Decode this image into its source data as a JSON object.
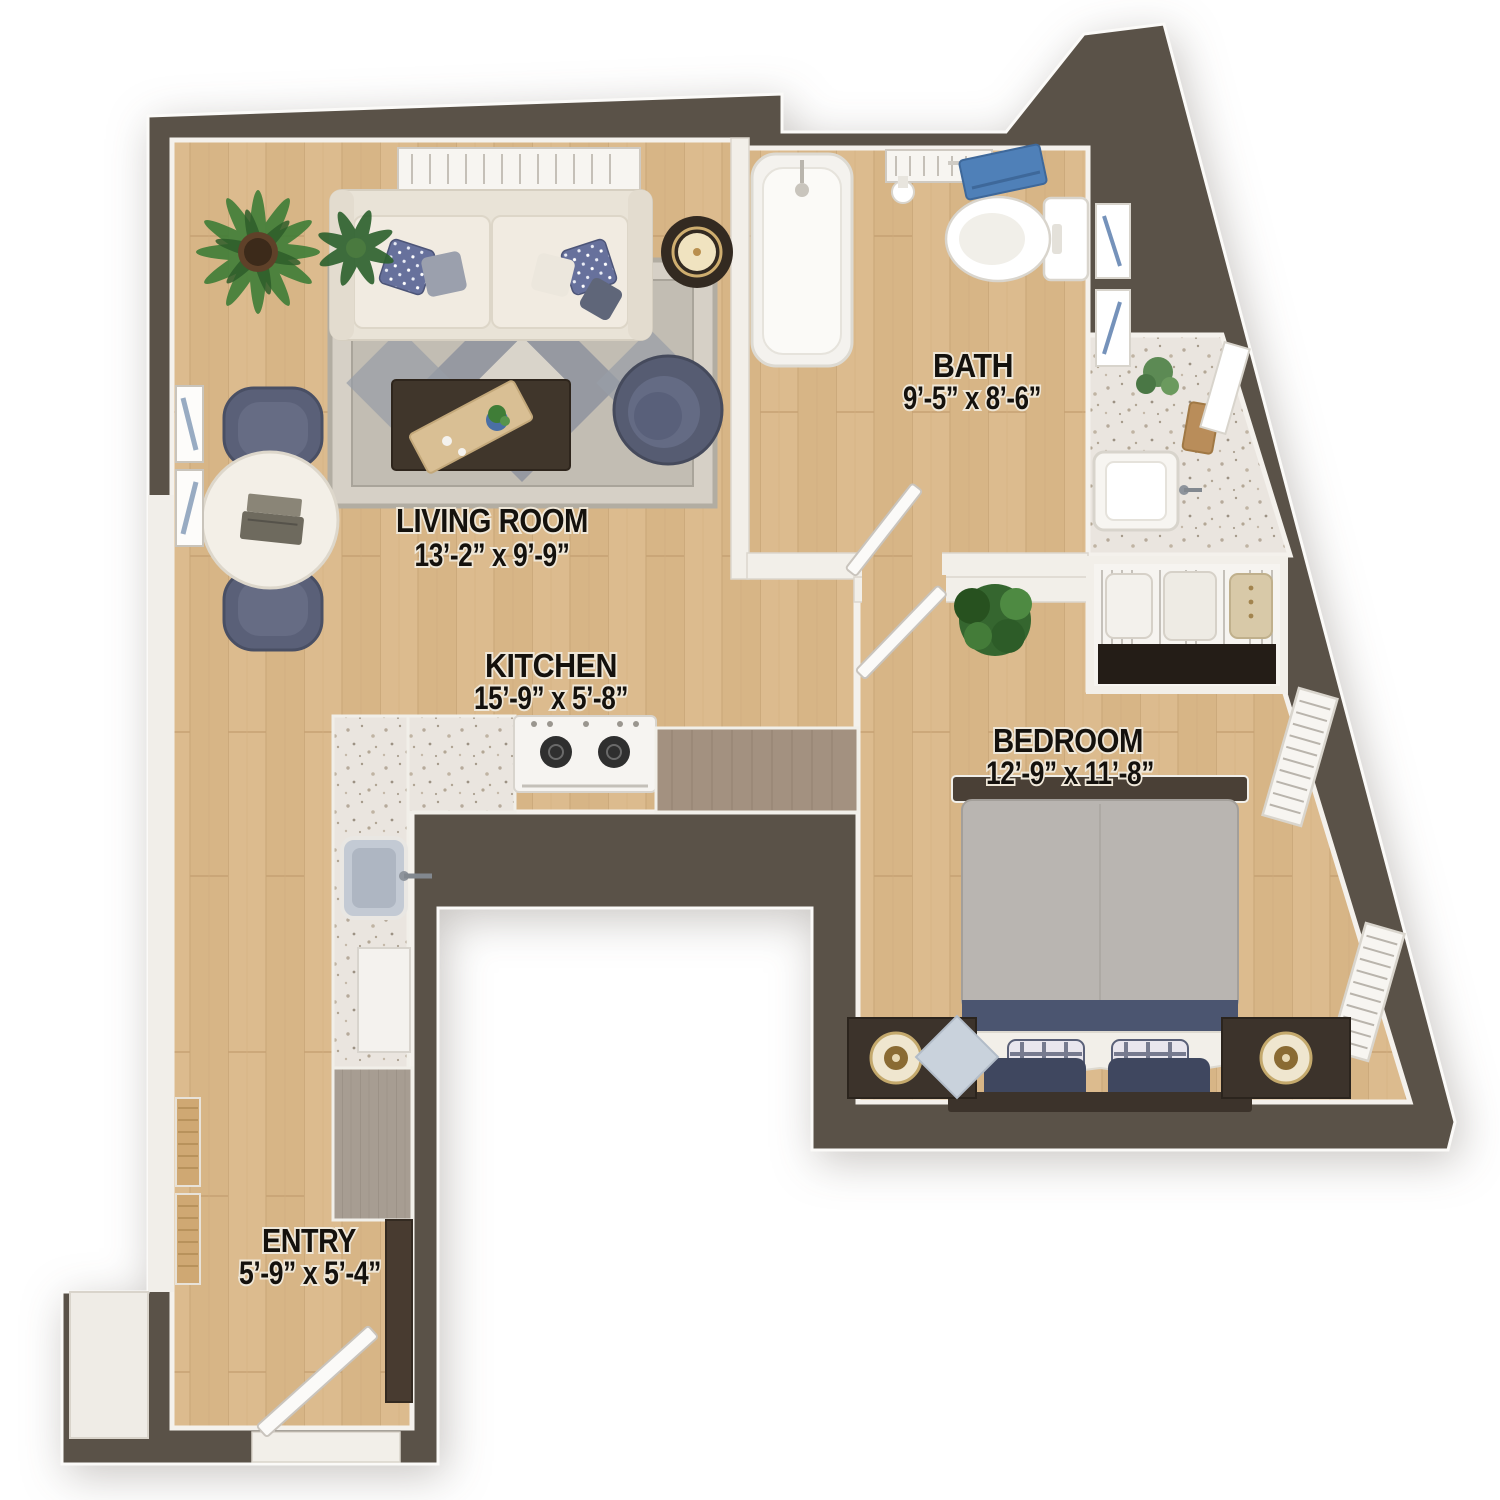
{
  "floorplan": {
    "view": "3d-top-down-apartment-floor-plan",
    "rooms": [
      {
        "name": "LIVING ROOM",
        "dimensions": "13’-2” x 9’-9”"
      },
      {
        "name": "KITCHEN",
        "dimensions": "15’-9” x 5’-8”"
      },
      {
        "name": "BATH",
        "dimensions": "9’-5” x 8’-6”"
      },
      {
        "name": "BEDROOM",
        "dimensions": "12’-9” x 11’-8”"
      },
      {
        "name": "ENTRY",
        "dimensions": "5’-9” x 5’-4”"
      }
    ],
    "colors": {
      "wall": "#5a5248",
      "wood_floor": "#dcbb8e",
      "tile_floor": "#eae5df",
      "trim_white": "#f3f0ea",
      "upholstery_navy": "#5a6078",
      "dark_wood": "#41362b",
      "towel_blue": "#4f80b8",
      "plant_green": "#3f7d37",
      "lamp_gold": "#cfae6f"
    },
    "furniture": [
      "sofa",
      "area-rug",
      "coffee-table",
      "armchair",
      "floor-lamp",
      "potted-plants",
      "cafe-table",
      "dining-chairs",
      "laptop",
      "wall-art",
      "range",
      "kitchen-sink",
      "dishwasher",
      "entry-cabinet",
      "bathtub",
      "toilet",
      "vanity-sink",
      "towel",
      "closet-clothes",
      "queen-bed",
      "nightstands",
      "bedroom-plant",
      "windows",
      "interior-doors",
      "entry-door"
    ]
  }
}
